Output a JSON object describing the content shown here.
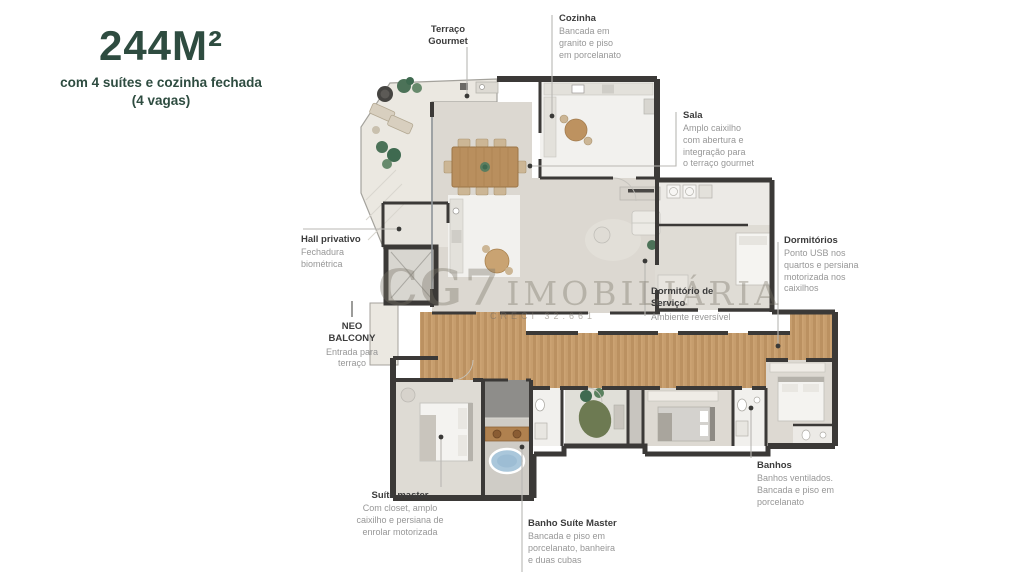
{
  "title": {
    "area": "244M²",
    "subtitle": "com 4 suítes e cozinha fechada\n(4 vagas)"
  },
  "watermark": {
    "brand": "CG7",
    "brand2": "IMOBILIÁRIA",
    "creci": "CRECI 32.661"
  },
  "labels": {
    "terraco_gourmet": {
      "heading": "Terraço\nGourmet"
    },
    "cozinha": {
      "heading": "Cozinha",
      "body": "Bancada em\ngranito e piso\nem porcelanato"
    },
    "sala": {
      "heading": "Sala",
      "body": "Amplo caixilho\ncom abertura e\nintegração para\no terraço gourmet"
    },
    "hall_privativo": {
      "heading": "Hall privativo",
      "body": "Fechadura\nbiométrica"
    },
    "neo_balcony": {
      "heading": "NEO\nBALCONY",
      "body": "Entrada para\nterraço"
    },
    "dormitorio_servico": {
      "heading": "Dormitório de\nServiço",
      "body": "Ambiente reversível"
    },
    "dormitorios": {
      "heading": "Dormitórios",
      "body": "Ponto USB nos\nquartos e persiana\nmotorizada nos\ncaixilhos"
    },
    "banhos": {
      "heading": "Banhos",
      "body": "Banhos ventilados.\nBancada e piso em\nporcelanato"
    },
    "suite_master": {
      "heading": "Suíte master",
      "body": "Com closet, amplo\ncaixilho e persiana de\nenrolar motorizada"
    },
    "banho_suite_master": {
      "heading": "Banho Suíte Master",
      "body": "Bancada e piso em\nporcelanato, banheira\ne duas cubas"
    }
  },
  "palette": {
    "title_green": "#2e4c40",
    "wall_dark": "#3b3937",
    "wood_floor": "#c69d6d",
    "floor_gray": "#dcd8d1",
    "floor_white": "#f2f1ee",
    "terrace_tile": "#ebe8e1",
    "tub_blue": "#aac7db",
    "plant_green": "#4a7257",
    "leader_gray": "#b9b7b3"
  }
}
